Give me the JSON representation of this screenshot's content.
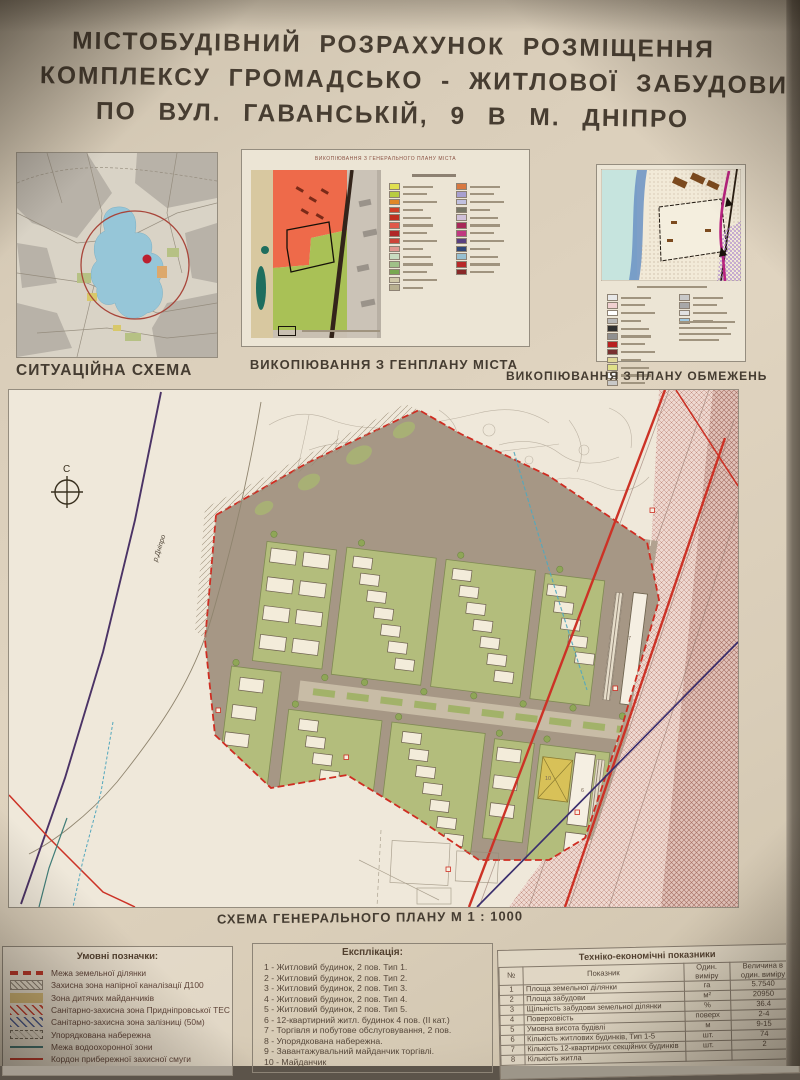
{
  "poster": {
    "title_lines": [
      "МІСТОБУДІВНИЙ  РОЗРАХУНОК  РОЗМІЩЕННЯ",
      "КОМПЛЕКСУ  ГРОМАДСЬКО - ЖИТЛОВОЇ  ЗАБУДОВИ",
      "ПО  ВУЛ. ГАВАНСЬКІЙ, 9  В  М. ДНІПРО"
    ]
  },
  "panels": {
    "situation": {
      "caption": "СИТУАЦІЙНА СХЕМА"
    },
    "genplan": {
      "caption": "ВИКОПІЮВАННЯ З ГЕНПЛАНУ МІСТА",
      "inner_title": "ВИКОПІЮВАННЯ З ГЕНЕРАЛЬНОГО ПЛАНУ МІСТА",
      "legend_col1": [
        "#e0e050",
        "#b8cc40",
        "#e08828",
        "#d04028",
        "#c03020",
        "#e05848",
        "#b02828",
        "#cc4438",
        "#e09890",
        "#c8dcc0",
        "#a0c088",
        "#78a850",
        "#d0c8a8",
        "#b8b090"
      ],
      "legend_col2": [
        "#d87840",
        "#a8a0d0",
        "#c0c0e0",
        "#787868",
        "#d0c0d8",
        "#a82858",
        "#c03880",
        "#584080",
        "#304878",
        "#98c0d0",
        "#b82828",
        "#882828"
      ]
    },
    "constraints": {
      "caption": "ВИКОПІЮВАННЯ З ПЛАНУ ОБМЕЖЕНЬ",
      "legend_col1": [
        "#e8e8e8",
        "#f0d0d0",
        "#ffffff",
        "#b8b8b8",
        "#303030",
        "#909090",
        "#b82020",
        "#783030",
        "#e0d898",
        "#e0e088",
        "#f8f8f8",
        "#c8c8c8"
      ],
      "legend_col2": [
        "#c8c8c8",
        "#a8a8a8",
        "#e0e0e0",
        "#a0c8e0"
      ]
    }
  },
  "master_plan": {
    "caption": "СХЕМА ГЕНЕРАЛЬНОГО ПЛАНУ М 1 : 1000",
    "compass_label": "С",
    "river_label": "р.Дніпро",
    "building_labels": [
      "7",
      "6",
      "10"
    ]
  },
  "legend": {
    "title": "Умовні позначки:",
    "items": [
      {
        "type": "dash-red",
        "label": "Межа земельної ділянки"
      },
      {
        "type": "hatch-gray",
        "label": "Захисна зона напірної каналізації Д100"
      },
      {
        "type": "solid-tan",
        "label": "Зона дитячих майданчиків"
      },
      {
        "type": "hatch-red",
        "label": "Санітарно-захисна зона Придніпровської ТЕС"
      },
      {
        "type": "hatch-blue",
        "label": "Санітарно-захисна зона залізниці (50м)"
      },
      {
        "type": "dash-box",
        "label": "Упорядкована набережна"
      },
      {
        "type": "line-teal",
        "label": "Межа водоохоронної зони"
      },
      {
        "type": "line-red",
        "label": "Кордон прибережної захисної смуги"
      }
    ]
  },
  "explication": {
    "title": "Експлікація:",
    "items": [
      "1 - Житловий будинок, 2 пов. Тип 1.",
      "2 - Житловий будинок, 2 пов. Тип 2.",
      "3 - Житловий будинок, 2 пов. Тип 3.",
      "4 - Житловий будинок, 2 пов. Тип 4.",
      "5 - Житловий будинок, 2 пов. Тип 5.",
      "6 - 12-квартирний житл. будинок 4 пов. (II кат.)",
      "7 - Торгівля и побутове обслуговування, 2 пов.",
      "8 - Упорядкована набережна.",
      "9 - Завантажувальний майданчик торгівлі.",
      "10 - Майданчик"
    ]
  },
  "tech_table": {
    "title": "Техніко-економічні показники",
    "col_headers": {
      "num": "№",
      "indicator": "Показник",
      "unit": "Один. виміру",
      "value": "Величина в один. виміру"
    },
    "rows": [
      {
        "num": "1",
        "indicator": "Площа земельної ділянки",
        "unit": "га",
        "value": "5.7540"
      },
      {
        "num": "2",
        "indicator": "Площа забудови",
        "unit": "м²",
        "value": "20950"
      },
      {
        "num": "3",
        "indicator": "Щільність забудови земельної ділянки",
        "unit": "%",
        "value": "36.4"
      },
      {
        "num": "4",
        "indicator": "Поверховість",
        "unit": "поверх",
        "value": "2-4"
      },
      {
        "num": "5",
        "indicator": "Умовна висота будівлі",
        "unit": "м",
        "value": "9-15"
      },
      {
        "num": "6",
        "indicator": "Кількість житлових будинків, Тип 1-5",
        "unit": "шт.",
        "value": "74"
      },
      {
        "num": "7",
        "indicator": "Кількість 12-квартирних секційних будинків",
        "unit": "шт.",
        "value": "2"
      },
      {
        "num": "8",
        "indicator": "Кількість житла",
        "unit": "",
        "value": ""
      }
    ]
  },
  "colors": {
    "poster_bg": "#d9cdb9",
    "boundary_red": "#cf2d22",
    "site_green": "#b3bd7c",
    "road_gray": "#a69785",
    "rail_hatch": "#c28e80",
    "water_blue": "#96c6d8",
    "playground_yellow": "#d8c158"
  }
}
